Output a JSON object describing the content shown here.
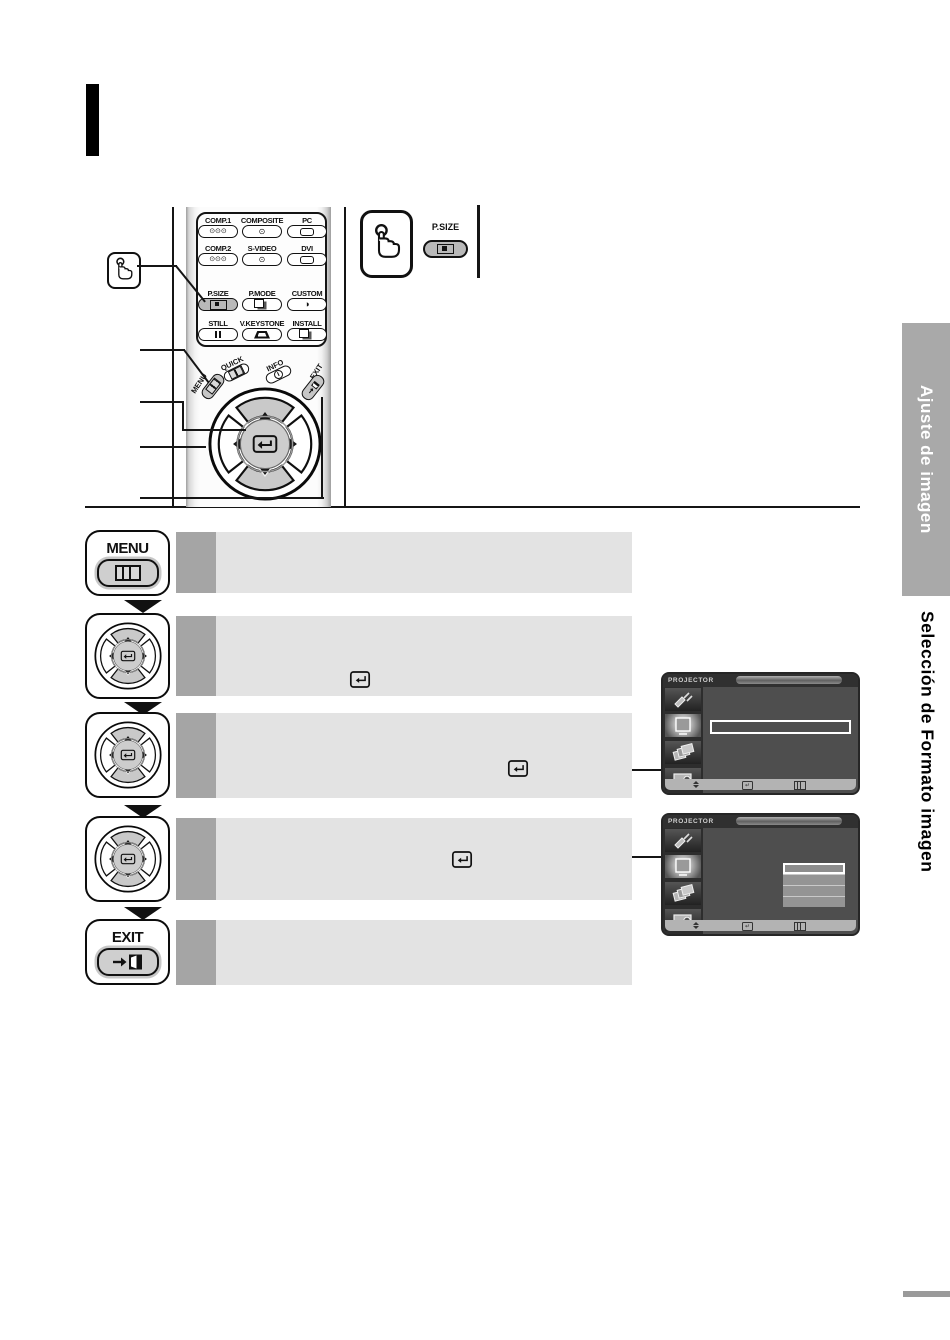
{
  "page": {
    "right_tab": "Ajuste de imagen",
    "right_subtitle": "Selección de Formato imagen"
  },
  "remote": {
    "grid": [
      {
        "label": "COMP.1",
        "icon": "triple-rca-icon"
      },
      {
        "label": "COMPOSITE",
        "icon": "rca-icon"
      },
      {
        "label": "PC",
        "icon": "dsub-connector-icon"
      },
      {
        "label": "COMP.2",
        "icon": "triple-rca-icon"
      },
      {
        "label": "S-VIDEO",
        "icon": "svideo-connector-icon"
      },
      {
        "label": "DVI",
        "icon": "dvi-connector-icon"
      },
      {
        "label": "P.SIZE",
        "icon": "picture-size-icon"
      },
      {
        "label": "P.MODE",
        "icon": "picture-mode-icon"
      },
      {
        "label": "CUSTOM",
        "icon": "contrast-icon"
      },
      {
        "label": "STILL",
        "icon": "pause-icon"
      },
      {
        "label": "V.KEYSTONE",
        "icon": "keystone-trapezoid-icon"
      },
      {
        "label": "INSTALL",
        "icon": "install-flip-icon"
      }
    ],
    "quick_label": "QUICK",
    "info_label": "INFO",
    "menu_label": "MENU",
    "exit_label": "EXIT"
  },
  "callout": {
    "psize_label": "P.SIZE",
    "hand_icon": "press-button-hand-icon"
  },
  "steps": [
    {
      "button_label": "MENU",
      "button_icon": "menu-grid-icon"
    },
    {
      "button_icon": "dpad-enter-icon",
      "row_icon": "enter-key-icon"
    },
    {
      "button_icon": "dpad-enter-icon",
      "row_icon": "enter-key-icon"
    },
    {
      "button_icon": "dpad-enter-icon",
      "row_icon": "enter-key-icon"
    },
    {
      "button_label": "EXIT",
      "button_icon": "exit-door-icon"
    }
  ],
  "screens": [
    {
      "title": "PROJECTOR",
      "sidebar_icons": [
        "input-source-icon",
        "picture-icon",
        "layers-icon",
        "setup-icon"
      ],
      "active_sidebar_icon": "picture-icon",
      "bottom_icons": [
        "move-updown-icon",
        "enter-icon",
        "menu-icon"
      ],
      "selection": "empty-highlight-bar"
    },
    {
      "title": "PROJECTOR",
      "sidebar_icons": [
        "input-source-icon",
        "picture-icon",
        "layers-icon",
        "setup-icon"
      ],
      "active_sidebar_icon": "picture-icon",
      "bottom_icons": [
        "move-updown-icon",
        "enter-icon",
        "menu-icon"
      ],
      "selection": "option-list-4-rows"
    }
  ],
  "colors": {
    "step_row": "#e3e3e3",
    "step_number_box": "#a5a5a5",
    "side_tab": "#a9a9a9",
    "screen_bg": "#4e4e4e",
    "screen_sidebar": "#2d2d2d",
    "highlight_pill": "#b9b9b9"
  }
}
